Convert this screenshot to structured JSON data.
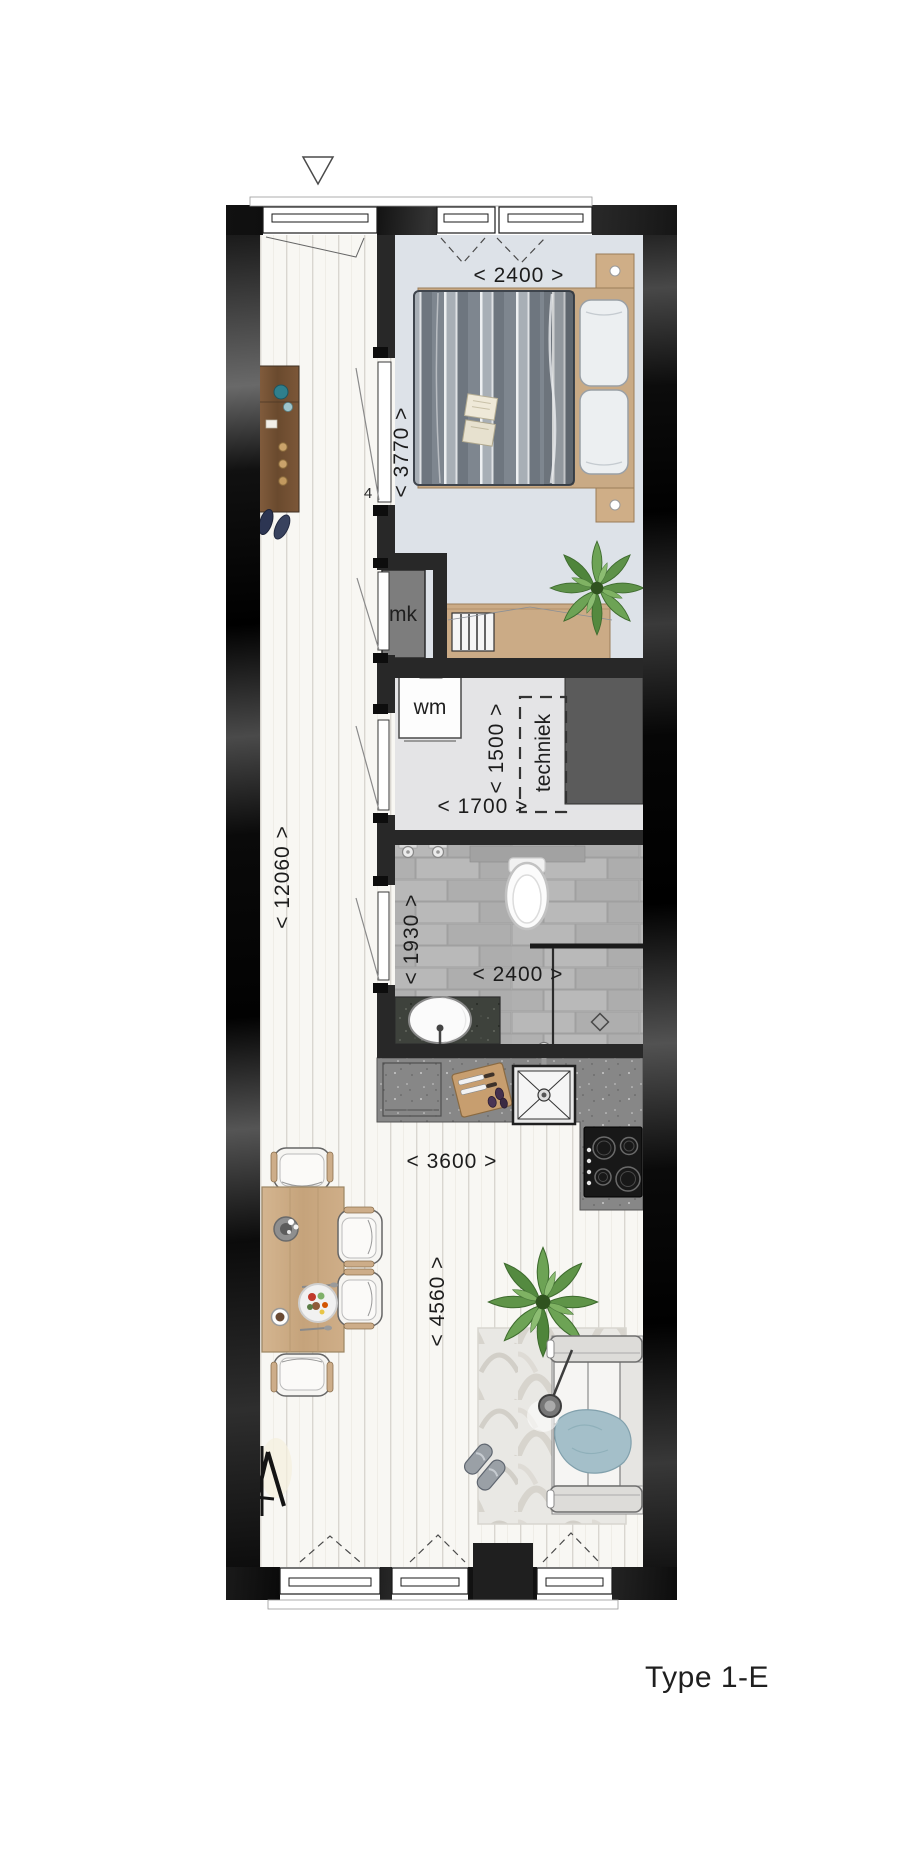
{
  "title": "Type 1-E",
  "marker": {
    "entrance": "triangle-down"
  },
  "dimensions": {
    "bedroom_width": "< 2400 >",
    "bedroom_depth": "< 3770 >",
    "corridor_length": "< 12060 >",
    "hall_depth": "< 1500 >",
    "hall_width": "< 1700 >",
    "bathroom_depth": "< 1930 >",
    "bathroom_width": "< 2400 >",
    "kitchen_width": "< 3600 >",
    "living_depth": "< 4560 >"
  },
  "fixtures": {
    "meter_cupboard": "mk",
    "washing_machine": "wm",
    "technical_room": "techniek",
    "door_note": "4"
  },
  "colors": {
    "wall": "#1a1a1a",
    "bedroom_floor": "#dde2e8",
    "hall_floor": "#e4e4e6",
    "wood_floor": "#f8f7f3",
    "tile_floor": "#b3b3b3",
    "kitchen_counter": "#878787",
    "dark_stone": "#3e423c",
    "furniture_wood": "#c9aa85",
    "plant_green": "#5d9148",
    "blanket_blue": "#a4bfc9",
    "duvet_gray": "#8b939b"
  }
}
